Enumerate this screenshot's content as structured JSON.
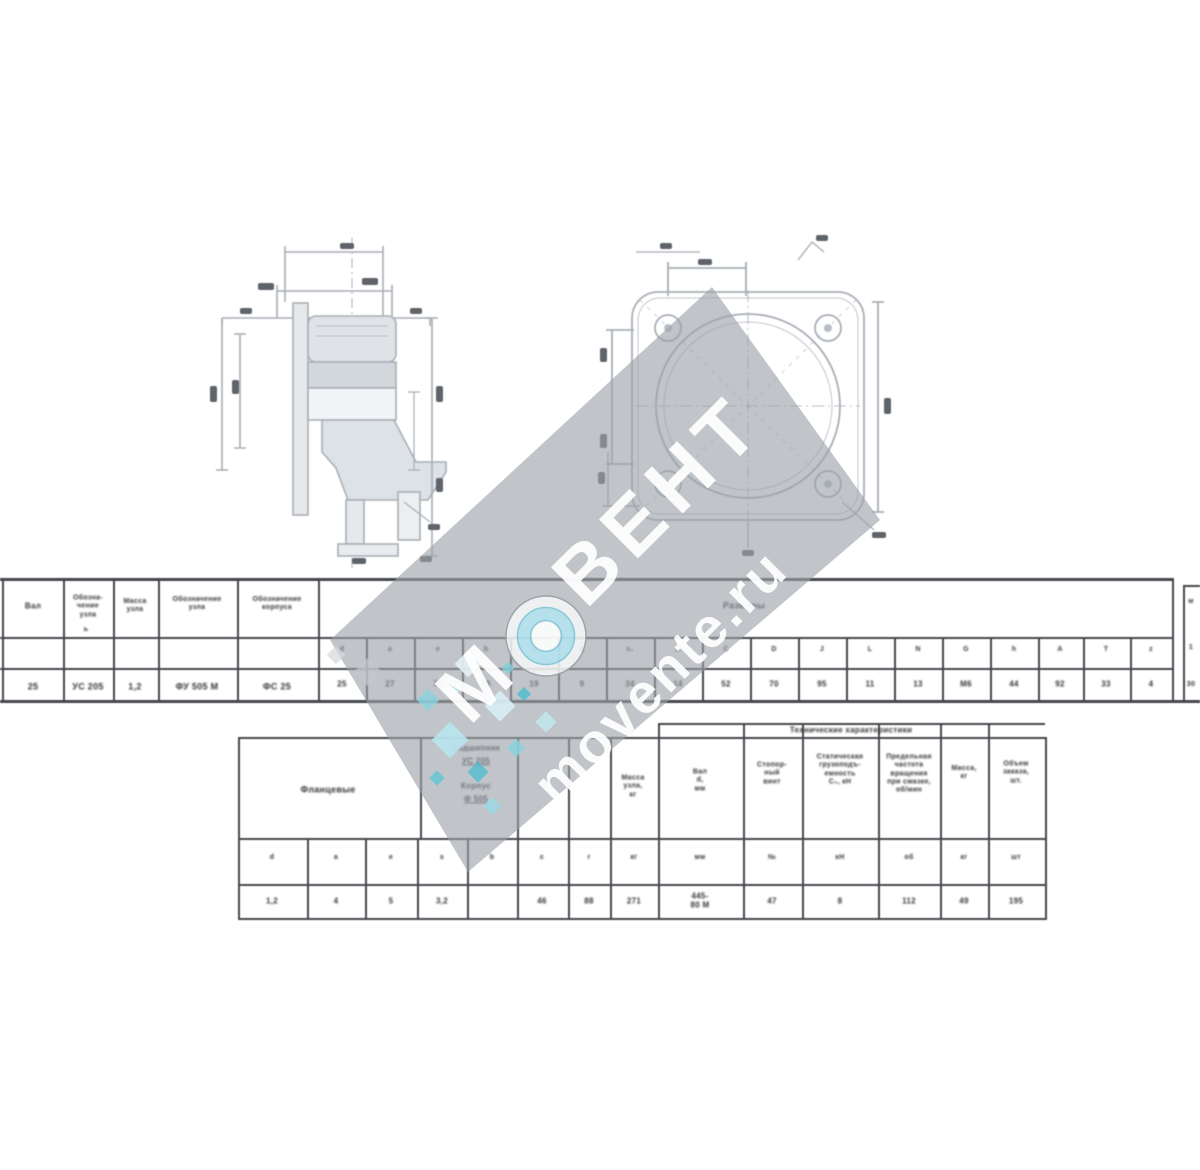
{
  "page": {
    "background": "#ffffff"
  },
  "watermark": {
    "brand_m": "М",
    "brand_rest": "ВЕНТ",
    "url": "movente.ru",
    "accent_teal": "#49bccd",
    "light_teal": "#b5e3ef",
    "diamond_gray": "#9ba1a8"
  },
  "tables": {
    "main": {
      "span": "Размеры",
      "columns": [
        "Вал",
        "Обозна-\nчение\nузла",
        "Масса\nузла",
        "Обозначение\nузла",
        "Обозначение\nкорпуса"
      ],
      "check": "ь",
      "row": [
        "25",
        "УС 205",
        "1,2",
        "ФУ 505 М",
        "ФС 25"
      ],
      "dims": [
        "d",
        "a",
        "e",
        "b",
        "c",
        "g",
        "s₁",
        "B",
        "C",
        "D",
        "J",
        "L",
        "N",
        "G",
        "h",
        "A",
        "T",
        "z"
      ],
      "values": [
        "25",
        "27",
        "70",
        "38",
        "19",
        "9",
        "34",
        "14",
        "52",
        "70",
        "95",
        "11",
        "13",
        "М6",
        "44",
        "92",
        "33",
        "4"
      ],
      "edge_marks": [
        "м",
        "1",
        "30"
      ]
    },
    "bottom": {
      "span": "Технические характеристики",
      "col_flange": "Фланцевые",
      "bearing_label": "Подшипник",
      "bearing_value": "УС 205",
      "housing_label": "Корпус",
      "housing_value": "Ф 505",
      "mass_header": "Масса\nузла,\nкг",
      "shaft_header": "Вал\nd,\nмм",
      "screw_header": "Стопор-\nный\nвинт",
      "static_header": "Статическая\nгрузоподъ-\nемность\nС₀, кН",
      "speed_header": "Предельная\nчастота\nвращения\nпри смазке,\nоб/мин",
      "unit_mass_header": "Масса,\nкг",
      "order_header": "Объем\nзаказа,\nшт.",
      "sub_marks": [
        "d",
        "a",
        "e",
        "s",
        "b",
        "c",
        "r",
        "кг",
        "мм",
        "№",
        "кН",
        "об",
        "кг",
        "шт"
      ],
      "row": [
        "1,2",
        "4",
        "5",
        "3,2",
        "",
        "46",
        "88",
        "271",
        "445-\n80 М",
        "47",
        "8",
        "112",
        "49",
        "195"
      ]
    }
  }
}
